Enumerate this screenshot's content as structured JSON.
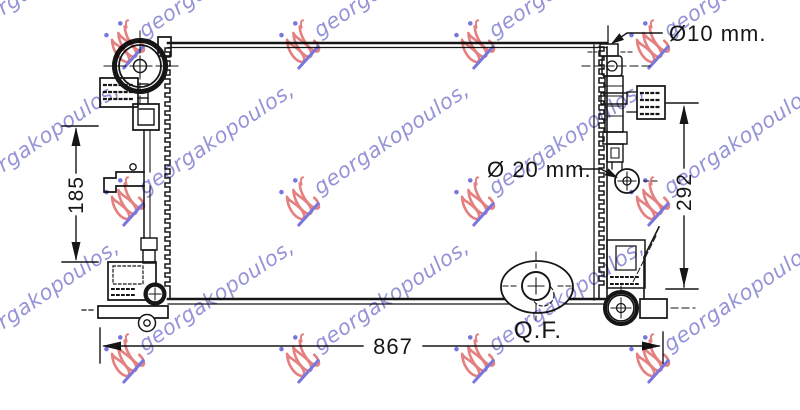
{
  "canvas": {
    "width_px": 800,
    "height_px": 410,
    "background": "#ffffff",
    "line_color": "#161616"
  },
  "drawing_labels": {
    "overall_width_mm": "867",
    "left_core_height_mm": "185",
    "right_core_height_mm": "292",
    "top_pipe_diameter": "Ø10 mm.",
    "side_pipe_diameter": "Ø 20 mm.",
    "quick_fit_marking": "Q.F."
  },
  "watermark": {
    "text": "georgakopoulos,",
    "angle_deg": -34,
    "text_color": "#8181d1",
    "logo_color": "#e06a6a",
    "accent_color": "#5f5fd8",
    "opacity": 0.85,
    "rows_y": [
      21,
      178,
      335
    ],
    "cols_x": [
      -67,
      108,
      283,
      458,
      633
    ]
  }
}
